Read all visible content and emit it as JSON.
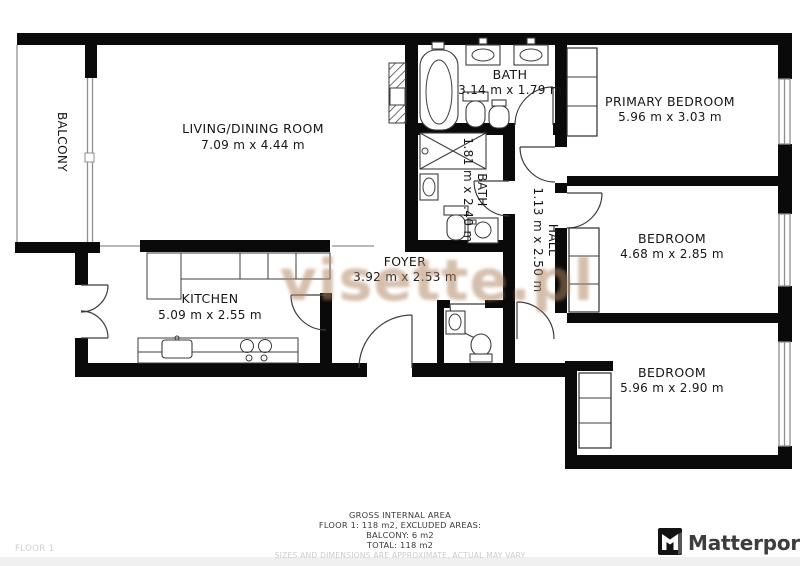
{
  "colors": {
    "wall": "#0a0a0a",
    "thin_line": "#8f8f8f",
    "fixture_line": "#3c3c3c",
    "watermark": "#b08562",
    "footer_text": "#3a3a3a",
    "muted_text": "#cccccc",
    "brand_text": "#3d3d3d"
  },
  "watermark": {
    "text": "visette.pl"
  },
  "rooms": {
    "living": {
      "name": "LIVING/DINING ROOM",
      "dims": "7.09 m x 4.44 m"
    },
    "kitchen": {
      "name": "KITCHEN",
      "dims": "5.09 m x 2.55 m"
    },
    "foyer": {
      "name": "FOYER",
      "dims": "3.92 m x 2.53 m"
    },
    "hall": {
      "name": "HALL",
      "dims": "1.13 m x 2.50 m"
    },
    "bath_main": {
      "name": "BATH",
      "dims": "3.14 m x 1.79 m"
    },
    "bath_second": {
      "name": "BATH",
      "dims": "1.81 m x 2.40 m"
    },
    "primary_bedroom": {
      "name": "PRIMARY BEDROOM",
      "dims": "5.96 m x 3.03 m"
    },
    "bedroom_mid": {
      "name": "BEDROOM",
      "dims": "4.68 m x 2.85 m"
    },
    "bedroom_bottom": {
      "name": "BEDROOM",
      "dims": "5.96 m x 2.90 m"
    },
    "balcony": {
      "name": "BALCONY"
    }
  },
  "footer": {
    "area_title": "GROSS INTERNAL AREA",
    "area_line1": "FLOOR 1: 118 m2, EXCLUDED AREAS:",
    "area_line2": "BALCONY: 6 m2",
    "area_line3": "TOTAL: 118 m2",
    "disclaimer": "SIZES AND DIMENSIONS ARE APPROXIMATE, ACTUAL MAY VARY",
    "floor_label": "FLOOR 1",
    "brand": "Matterport",
    "brand_icon": "matterport-mark"
  }
}
